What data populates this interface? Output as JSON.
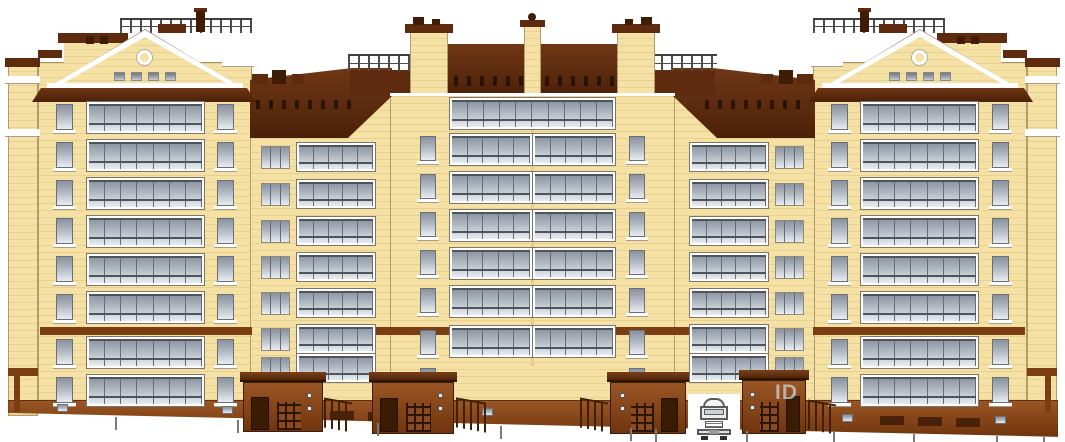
{
  "meta": {
    "title": "Residential building facade elevation drawing",
    "type": "architectural-elevation"
  },
  "watermark": {
    "text": "ID"
  },
  "canvas": {
    "w": 1065,
    "h": 442,
    "bg": "#FFFFFF",
    "mirror_width": 1065
  },
  "colors": {
    "wall": "#F5E1A4",
    "wallShade": "#E8CD86",
    "white": "#FFFFFF",
    "trimShadow": "#A59D8A",
    "roof": "#5E2B0F",
    "roofDark": "#3E1C06",
    "roofGradTop": "#6F3715",
    "roofGradBot": "#4C2108",
    "band": "#7A3E12",
    "brickTop": "#9A5524",
    "brickBot": "#70350E",
    "door": "#3A1B03",
    "glassTop": "#89929e",
    "glassBot": "#e9edf2",
    "frameDark": "#666c75",
    "railing": "#3f3f3f",
    "tick": "#7a7a7a"
  },
  "elements": [
    {
      "n": "side-return-wall",
      "t": "rect",
      "x": 8,
      "y": 66,
      "w": 30,
      "h": 350,
      "c": "wall",
      "tex": 1,
      "ol": 1,
      "m": 1
    },
    {
      "n": "tower-wall",
      "t": "rect",
      "x": 38,
      "y": 62,
      "w": 214,
      "h": 346,
      "c": "wall",
      "tex": 1,
      "ol": 1,
      "m": 1
    },
    {
      "n": "shoulder-wall",
      "t": "rect",
      "x": 250,
      "y": 95,
      "w": 142,
      "h": 325,
      "c": "wall",
      "tex": 1,
      "ol": 1,
      "m": 1
    },
    {
      "n": "center-wall",
      "t": "rect",
      "x": 390,
      "y": 90,
      "w": 285,
      "h": 330,
      "c": "wall",
      "tex": 1,
      "ol": 1
    },
    {
      "n": "center-joint-line",
      "t": "rect",
      "x": 531,
      "y": 96,
      "w": 3,
      "h": 270,
      "c": "wallShade"
    },
    {
      "n": "base-plinth",
      "t": "rect",
      "x": 8,
      "y": 400,
      "w": 1050,
      "h": 38,
      "c": "brickGrad",
      "cp": "polygon(0 0,100% 0,100% 97%,0 34%)",
      "ol": 1
    },
    {
      "n": "roof-deck-railing",
      "t": "railing",
      "x": 120,
      "y": 18,
      "w": 132,
      "h": 15,
      "m": 1
    },
    {
      "n": "roof-box",
      "t": "rect",
      "x": 158,
      "y": 24,
      "w": 28,
      "h": 9,
      "c": "roof",
      "m": 1
    },
    {
      "n": "chimney-cap",
      "t": "rect",
      "x": 194,
      "y": 8,
      "w": 13,
      "h": 4,
      "c": "roof",
      "m": 1
    },
    {
      "n": "chimney",
      "t": "rect",
      "x": 196,
      "y": 11,
      "w": 9,
      "h": 21,
      "c": "roofDark",
      "m": 1
    },
    {
      "n": "side-wing-cap",
      "t": "rect",
      "x": 58,
      "y": 33,
      "w": 70,
      "h": 10,
      "c": "roof",
      "m": 1
    },
    {
      "n": "side-wing-wall",
      "t": "rect",
      "x": 64,
      "y": 43,
      "w": 58,
      "h": 21,
      "c": "wall",
      "tex": 1,
      "m": 1
    },
    {
      "n": "side-wing-cap2",
      "t": "rect",
      "x": 38,
      "y": 50,
      "w": 24,
      "h": 8,
      "c": "roof",
      "m": 1
    },
    {
      "n": "side-wing-stub-1",
      "t": "rect",
      "x": 86,
      "y": 36,
      "w": 8,
      "h": 8,
      "c": "roofDark",
      "m": 1
    },
    {
      "n": "side-wing-stub-2",
      "t": "rect",
      "x": 100,
      "y": 36,
      "w": 8,
      "h": 8,
      "c": "roofDark",
      "m": 1
    },
    {
      "n": "side-return-cap",
      "t": "rect",
      "x": 5,
      "y": 58,
      "w": 35,
      "h": 9,
      "c": "roof",
      "m": 1
    },
    {
      "n": "wing-roof",
      "t": "rect",
      "x": 250,
      "y": 68,
      "w": 142,
      "h": 70,
      "c": "roofGrad",
      "cp": "polygon(0 17%,72% 0,100% 0,100% 40%,69% 100%,0 100%)",
      "m": 1
    },
    {
      "n": "wing-roof-vents",
      "t": "dashrow",
      "x": 256,
      "y": 100,
      "w": 104,
      "h": 9,
      "m": 1
    },
    {
      "n": "wing-chimney-a",
      "t": "rect",
      "x": 252,
      "y": 74,
      "w": 16,
      "h": 10,
      "c": "roof",
      "m": 1
    },
    {
      "n": "wing-chimney-b",
      "t": "rect",
      "x": 272,
      "y": 70,
      "w": 14,
      "h": 14,
      "c": "roofDark",
      "m": 1
    },
    {
      "n": "wing-chimney-c",
      "t": "rect",
      "x": 292,
      "y": 74,
      "w": 12,
      "h": 10,
      "c": "roof",
      "m": 1
    },
    {
      "n": "mansard-roof",
      "t": "rect",
      "x": 386,
      "y": 44,
      "w": 293,
      "h": 52,
      "c": "roofGrad",
      "cp": "polygon(16% 0,84% 0,100% 100%,0 100%)"
    },
    {
      "n": "mansard-vents",
      "t": "dashrow",
      "x": 402,
      "y": 76,
      "w": 262,
      "h": 10
    },
    {
      "n": "terrace-parapet",
      "t": "rect",
      "x": 350,
      "y": 70,
      "w": 64,
      "h": 26,
      "c": "roof",
      "m": 1
    },
    {
      "n": "terrace-railing",
      "t": "railing",
      "x": 348,
      "y": 54,
      "w": 66,
      "h": 17,
      "m": 1
    },
    {
      "n": "terrace-tower",
      "t": "rect",
      "x": 410,
      "y": 30,
      "w": 38,
      "h": 66,
      "c": "wall",
      "tex": 1,
      "ol": 1,
      "m": 1
    },
    {
      "n": "terrace-tower-cap",
      "t": "rect",
      "x": 405,
      "y": 24,
      "w": 48,
      "h": 9,
      "c": "roof",
      "m": 1
    },
    {
      "n": "terrace-tower-stub-1",
      "t": "rect",
      "x": 413,
      "y": 17,
      "w": 11,
      "h": 8,
      "c": "roofDark",
      "m": 1
    },
    {
      "n": "terrace-tower-stub-2",
      "t": "rect",
      "x": 432,
      "y": 19,
      "w": 8,
      "h": 6,
      "c": "roofDark",
      "m": 1
    },
    {
      "n": "central-pillar",
      "t": "rect",
      "x": 524,
      "y": 26,
      "w": 17,
      "h": 70,
      "c": "wall",
      "tex": 1,
      "ol": 1
    },
    {
      "n": "central-pillar-cap",
      "t": "rect",
      "x": 520,
      "y": 20,
      "w": 25,
      "h": 7,
      "c": "roof"
    },
    {
      "n": "central-pillar-finial",
      "t": "rect",
      "x": 528,
      "y": 13,
      "w": 8,
      "h": 8,
      "c": "roofDark",
      "rad": "50%"
    },
    {
      "n": "center-eave-line",
      "t": "rect",
      "x": 390,
      "y": 93,
      "w": 285,
      "h": 3,
      "c": "white"
    },
    {
      "n": "pediment",
      "t": "pediment",
      "x": 47,
      "y": 30,
      "w": 196,
      "h": 58,
      "m": 1
    },
    {
      "n": "attic-window-row",
      "t": "atticrow",
      "x": 114,
      "y": 72,
      "w": 62,
      "h": 9,
      "count": 4,
      "m": 1
    },
    {
      "n": "tower-corner-cap",
      "t": "rect",
      "x": 222,
      "y": 58,
      "w": 32,
      "h": 8,
      "c": "white",
      "sh": 1,
      "m": 1
    },
    {
      "n": "tower-eave",
      "t": "rect",
      "x": 32,
      "y": 88,
      "w": 224,
      "h": 14,
      "c": "roofGrad",
      "cp": "polygon(0 100%,4% 0,96% 0,100% 100%)",
      "m": 1
    },
    {
      "n": "side-return-cornice-1",
      "t": "rect",
      "x": 5,
      "y": 76,
      "w": 35,
      "h": 7,
      "c": "white",
      "sh": 1,
      "m": 1
    },
    {
      "n": "side-return-cornice-2",
      "t": "rect",
      "x": 5,
      "y": 129,
      "w": 35,
      "h": 7,
      "c": "white",
      "sh": 1,
      "m": 1
    },
    {
      "n": "tower-tie-band",
      "t": "rect",
      "x": 40,
      "y": 327,
      "w": 212,
      "h": 8,
      "c": "band",
      "m": 1
    },
    {
      "n": "center-tie-band",
      "t": "rect",
      "x": 371,
      "y": 327,
      "w": 78,
      "h": 8,
      "c": "band",
      "m": 1
    },
    {
      "n": "side-return-band",
      "t": "rect",
      "x": 8,
      "y": 368,
      "w": 30,
      "h": 8,
      "c": "band",
      "m": 1
    },
    {
      "n": "side-return-post",
      "t": "rect",
      "x": 14,
      "y": 376,
      "w": 6,
      "h": 36,
      "c": "band",
      "m": 1
    },
    {
      "n": "tower-narrow-col-outer",
      "t": "narrowcol",
      "x": 56,
      "w": 17,
      "h": 26,
      "rows": [
        104,
        142,
        180,
        218,
        256,
        294,
        339,
        377
      ],
      "m": 1
    },
    {
      "n": "tower-loggia-col",
      "t": "loggiacol",
      "x": 87,
      "w": 117,
      "h": 31,
      "p": 7,
      "rows": [
        102,
        140,
        178,
        216,
        254,
        292,
        337,
        375
      ],
      "m": 1
    },
    {
      "n": "tower-narrow-col-inner",
      "t": "narrowcol",
      "x": 217,
      "w": 17,
      "h": 26,
      "rows": [
        104,
        142,
        180,
        218,
        256,
        294,
        339,
        377
      ],
      "m": 1
    },
    {
      "n": "shoulder-small-window-col",
      "t": "small3col",
      "x": 261,
      "w": 29,
      "h": 23,
      "rows": [
        146,
        183,
        220,
        256,
        292,
        328,
        357
      ],
      "m": 1
    },
    {
      "n": "shoulder-loggia-col",
      "t": "loggiacol",
      "x": 297,
      "w": 78,
      "h": 28,
      "p": 5,
      "rows": [
        143,
        180,
        217,
        253,
        289,
        325,
        354
      ],
      "m": 1
    },
    {
      "n": "center-narrow-col",
      "t": "narrowcol",
      "x": 420,
      "w": 16,
      "h": 25,
      "rows": [
        136,
        174,
        212,
        250,
        288,
        330,
        368
      ],
      "m": 1
    },
    {
      "n": "center-top-loggia",
      "t": "loggia",
      "x": 450,
      "y": 98,
      "w": 165,
      "h": 31,
      "p": 10
    },
    {
      "n": "center-loggia-col",
      "t": "loggiacol",
      "x": 450,
      "w": 82,
      "h": 31,
      "p": 5,
      "rows": [
        134,
        172,
        210,
        248,
        286,
        326
      ],
      "m": 1
    },
    {
      "n": "basement-windows",
      "t": "winrow",
      "pts": [
        [
          57,
          404
        ],
        [
          222,
          406
        ],
        [
          482,
          408
        ],
        [
          655,
          409
        ],
        [
          842,
          414
        ],
        [
          995,
          416
        ]
      ],
      "w": 11,
      "h": 8
    },
    {
      "n": "basement-vents",
      "t": "ventrow",
      "pts": [
        [
          292,
          410
        ],
        [
          330,
          411
        ],
        [
          368,
          412
        ],
        [
          880,
          416
        ],
        [
          918,
          417
        ],
        [
          956,
          418
        ]
      ],
      "w": 24,
      "h": 9
    },
    {
      "n": "entrance-porch-1",
      "t": "porch",
      "x": 243,
      "y": 372,
      "w": 80,
      "h": 60
    },
    {
      "n": "entrance-porch-2",
      "t": "porch",
      "x": 372,
      "y": 372,
      "w": 82,
      "h": 62
    },
    {
      "n": "entrance-porch-3",
      "t": "porch",
      "x": 610,
      "y": 372,
      "w": 76,
      "h": 62,
      "f": 1
    },
    {
      "n": "entrance-porch-4",
      "t": "porch",
      "x": 742,
      "y": 370,
      "w": 64,
      "h": 64,
      "f": 1
    },
    {
      "n": "step-railing-1",
      "t": "steprail",
      "x": 324,
      "y": 400,
      "w": 28,
      "h": 30
    },
    {
      "n": "step-railing-2",
      "t": "steprail",
      "x": 456,
      "y": 400,
      "w": 30,
      "h": 30
    },
    {
      "n": "step-railing-3",
      "t": "steprail",
      "x": 580,
      "y": 400,
      "w": 28,
      "h": 30
    },
    {
      "n": "step-railing-4",
      "t": "steprail",
      "x": 808,
      "y": 402,
      "w": 28,
      "h": 30
    },
    {
      "n": "passage-gap",
      "t": "rect",
      "x": 688,
      "y": 394,
      "w": 52,
      "h": 46,
      "c": "white"
    },
    {
      "n": "truck",
      "t": "truck",
      "x": 697,
      "y": 398,
      "w": 34,
      "h": 42
    },
    {
      "n": "ground-ticks",
      "t": "ticks",
      "xs": [
        115,
        237,
        377,
        500,
        630,
        655,
        746,
        833,
        913,
        996,
        1043
      ]
    },
    {
      "n": "watermark",
      "t": "wmark",
      "x": 775,
      "y": 381,
      "w": 60,
      "h": 26
    }
  ]
}
